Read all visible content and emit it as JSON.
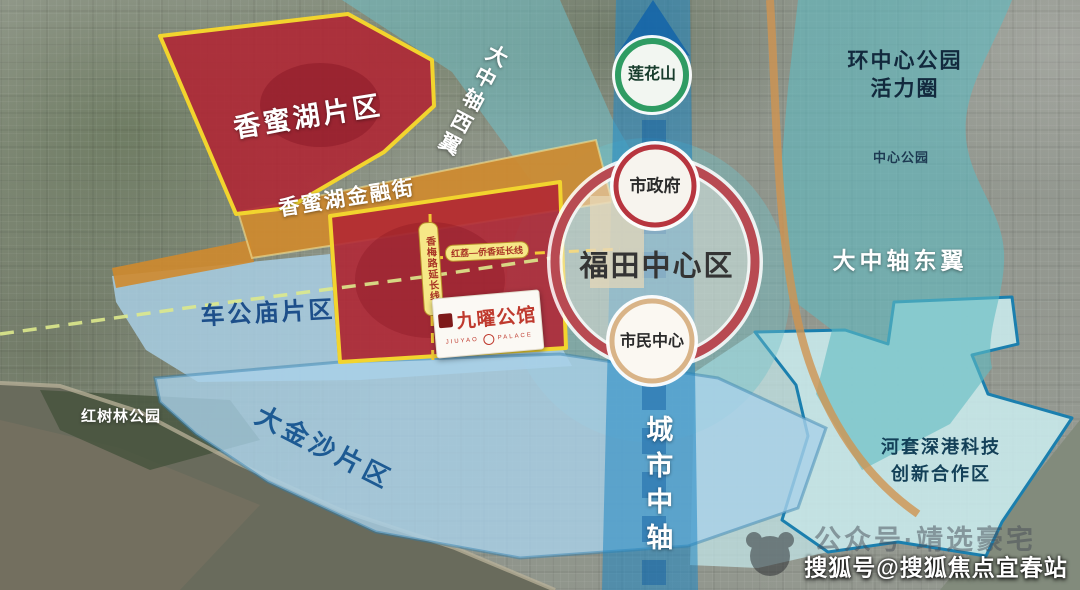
{
  "regions": {
    "xiangmihu": {
      "label": "香蜜湖片区",
      "color": "#b02433"
    },
    "financial_street": {
      "label": "香蜜湖金融街",
      "color": "#cf8a2e"
    },
    "chegongmiao": {
      "label": "车公庙片区",
      "color": "#a9d1e8"
    },
    "dajinsha": {
      "label": "大金沙片区",
      "color": "#a9d1e8"
    },
    "hongshulin_park": {
      "label": "红树林公园"
    },
    "west_wing": {
      "label": "大中轴西翼",
      "color": "#6fc0c8"
    },
    "east_wing": {
      "label": "大中轴东翼",
      "color": "#5fbac2"
    },
    "central_park_ring": {
      "line1": "环中心公园",
      "line2": "活力圈"
    },
    "central_park": {
      "label": "中心公园"
    },
    "hetao": {
      "line1": "河套深港科技",
      "line2": "创新合作区",
      "fill": "#cdeef0",
      "border": "#1b7fae"
    },
    "city_axis": {
      "label": "城市中轴",
      "color": "#1f86c2"
    },
    "futian_center": {
      "label": "福田中心区",
      "ring_color": "#b84a52"
    }
  },
  "circles": {
    "lianhuashan": {
      "label": "莲花山",
      "ring_color": "#2f9c63"
    },
    "city_government": {
      "label": "市政府",
      "ring_color": "#b7353f"
    },
    "civic_center": {
      "label": "市民中心",
      "ring_color": "#d9b488"
    }
  },
  "roads": {
    "north_south_extension": {
      "label": "香梅路延长线"
    },
    "east_west_extension": {
      "label": "红荔—侨香延长线"
    }
  },
  "project": {
    "name": "九曜公馆",
    "tagline_left": "JIUYAO",
    "tagline_right": "PALACE"
  },
  "watermarks": {
    "faint": "公众号·靖选豪宅",
    "souhu": "搜狐号@搜狐焦点宜春站"
  },
  "palette": {
    "boundary_yellow": "#f2d42e",
    "dashed_yellow": "#f3c936",
    "dashed_green": "#dde98c"
  }
}
